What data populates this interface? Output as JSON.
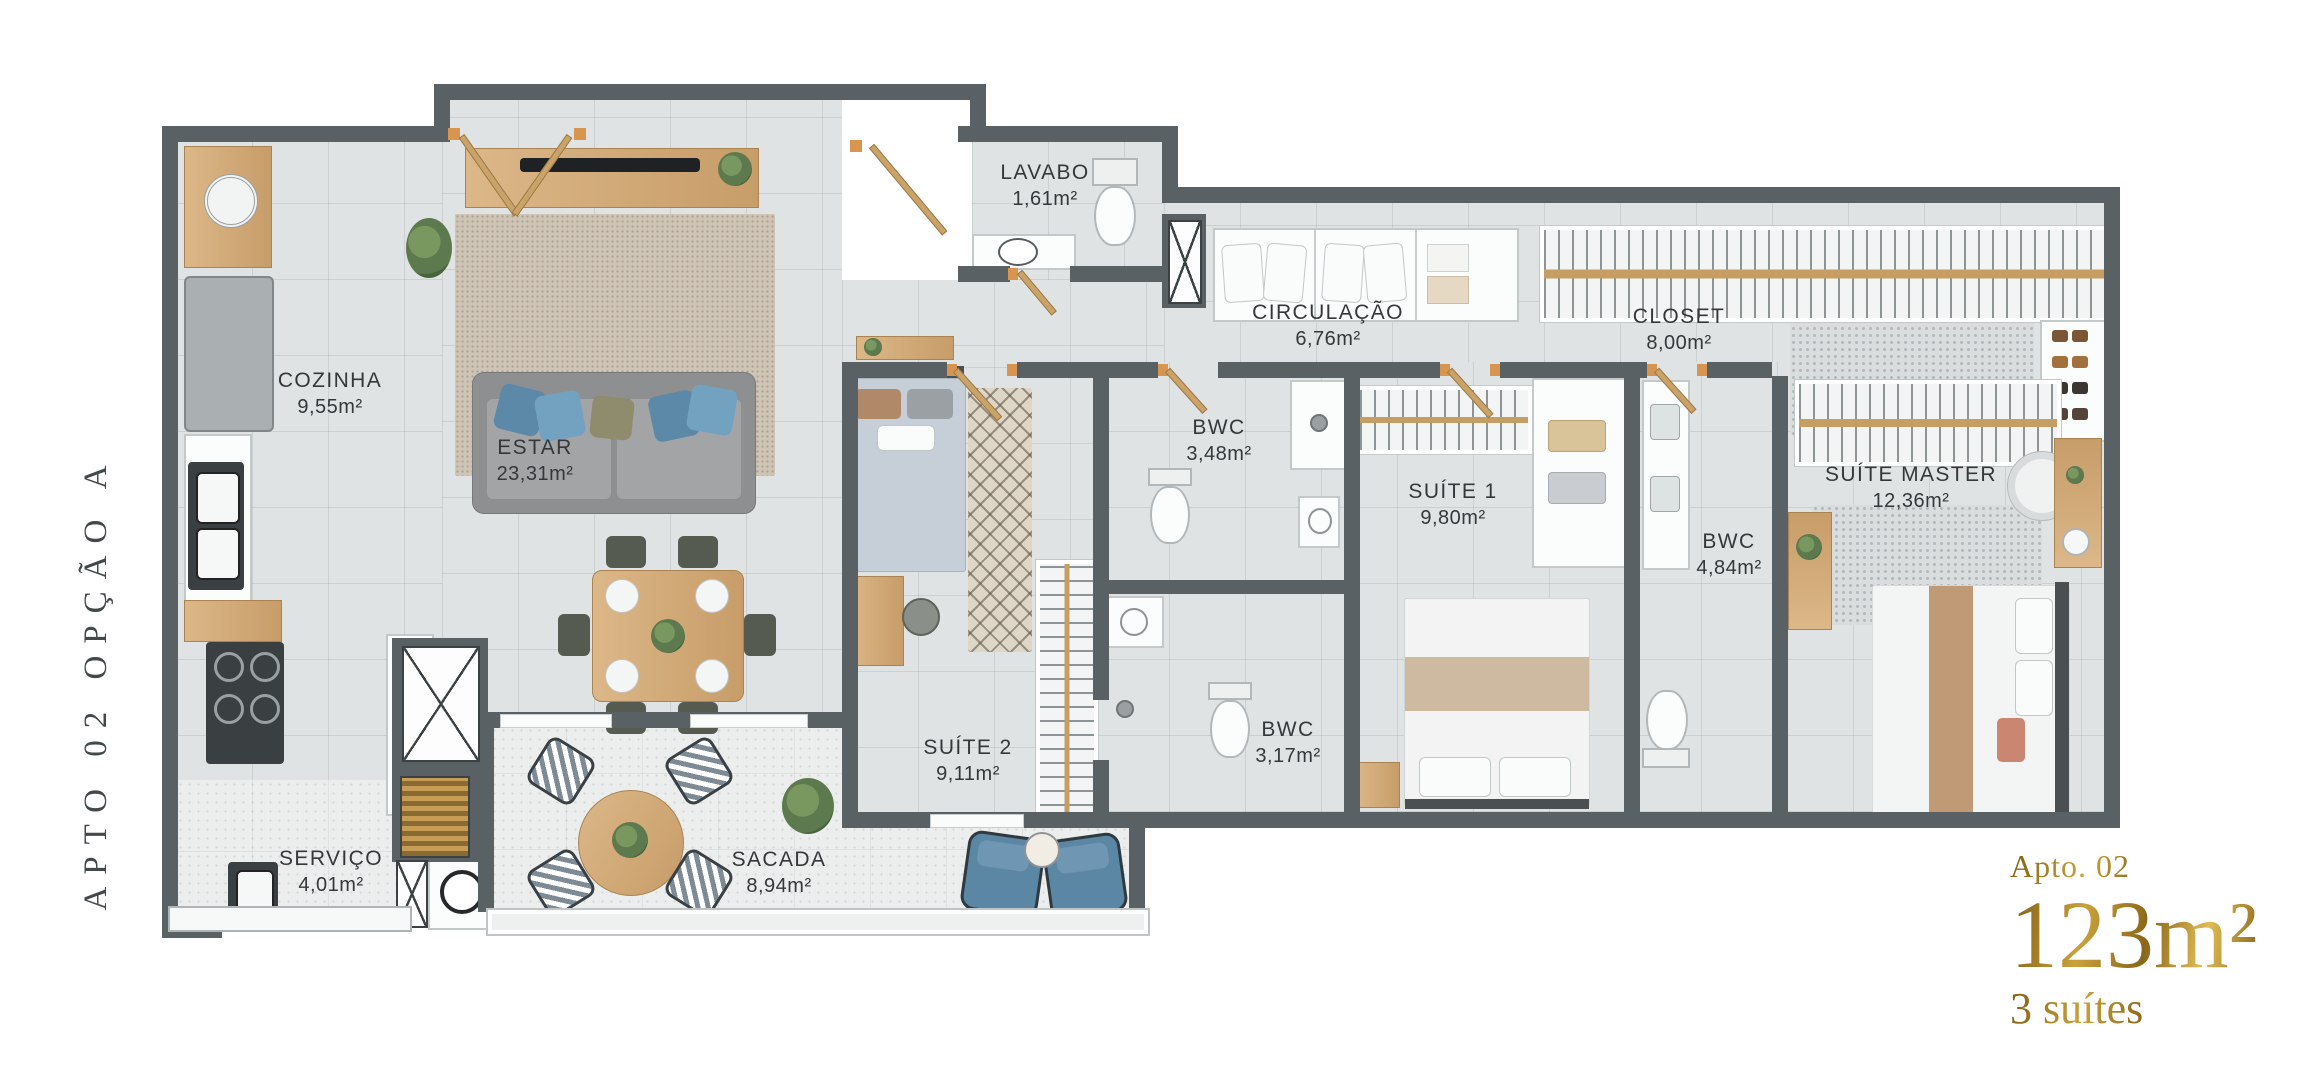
{
  "title_side": "APTO 02 OPÇÃO A",
  "rooms": [
    {
      "name": "COZINHA",
      "area": "9,55m²"
    },
    {
      "name": "ESTAR",
      "area": "23,31m²"
    },
    {
      "name": "LAVABO",
      "area": "1,61m²"
    },
    {
      "name": "CIRCULAÇÃO",
      "area": "6,76m²"
    },
    {
      "name": "CLOSET",
      "area": "8,00m²"
    },
    {
      "name": "BWC",
      "area": "3,48m²"
    },
    {
      "name": "SUÍTE 1",
      "area": "9,80m²"
    },
    {
      "name": "BWC",
      "area": "4,84m²"
    },
    {
      "name": "SUÍTE MASTER",
      "area": "12,36m²"
    },
    {
      "name": "SUÍTE 2",
      "area": "9,11m²"
    },
    {
      "name": "BWC",
      "area": "3,17m²"
    },
    {
      "name": "SERVIÇO",
      "area": "4,01m²"
    },
    {
      "name": "SACADA",
      "area": "8,94m²"
    }
  ],
  "summary": {
    "apt": "Apto. 02",
    "area": "123m²",
    "suites": "3 suítes"
  },
  "colors": {
    "wall": "#5a6164",
    "floor": "#e0e3e4",
    "floor_light": "#eceeee",
    "gold": "#a87f24",
    "wood": "#d2ab79",
    "accent_blue": "#5b86a4",
    "label_text": "#34383a"
  }
}
